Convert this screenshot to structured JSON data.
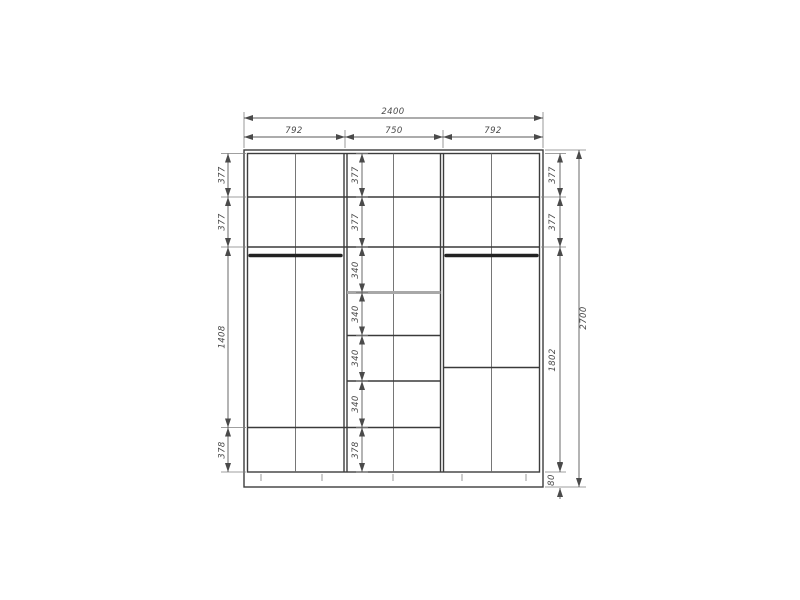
{
  "colors": {
    "background": "#ffffff",
    "structure_line": "#3d3d3d",
    "dimension_line": "#5a5a5a",
    "dimension_text": "#4a4a4a",
    "light_shelf": "#a8a8a8"
  },
  "dimensions": {
    "overall_width": "2400",
    "overall_height": "2700",
    "top_sections": [
      "792",
      "750",
      "792"
    ],
    "left_column": [
      "377",
      "377",
      "1408",
      "378"
    ],
    "middle_column": [
      "377",
      "377",
      "340",
      "340",
      "340",
      "340",
      "378"
    ],
    "right_column": [
      "377",
      "377",
      "1802",
      "80"
    ]
  }
}
